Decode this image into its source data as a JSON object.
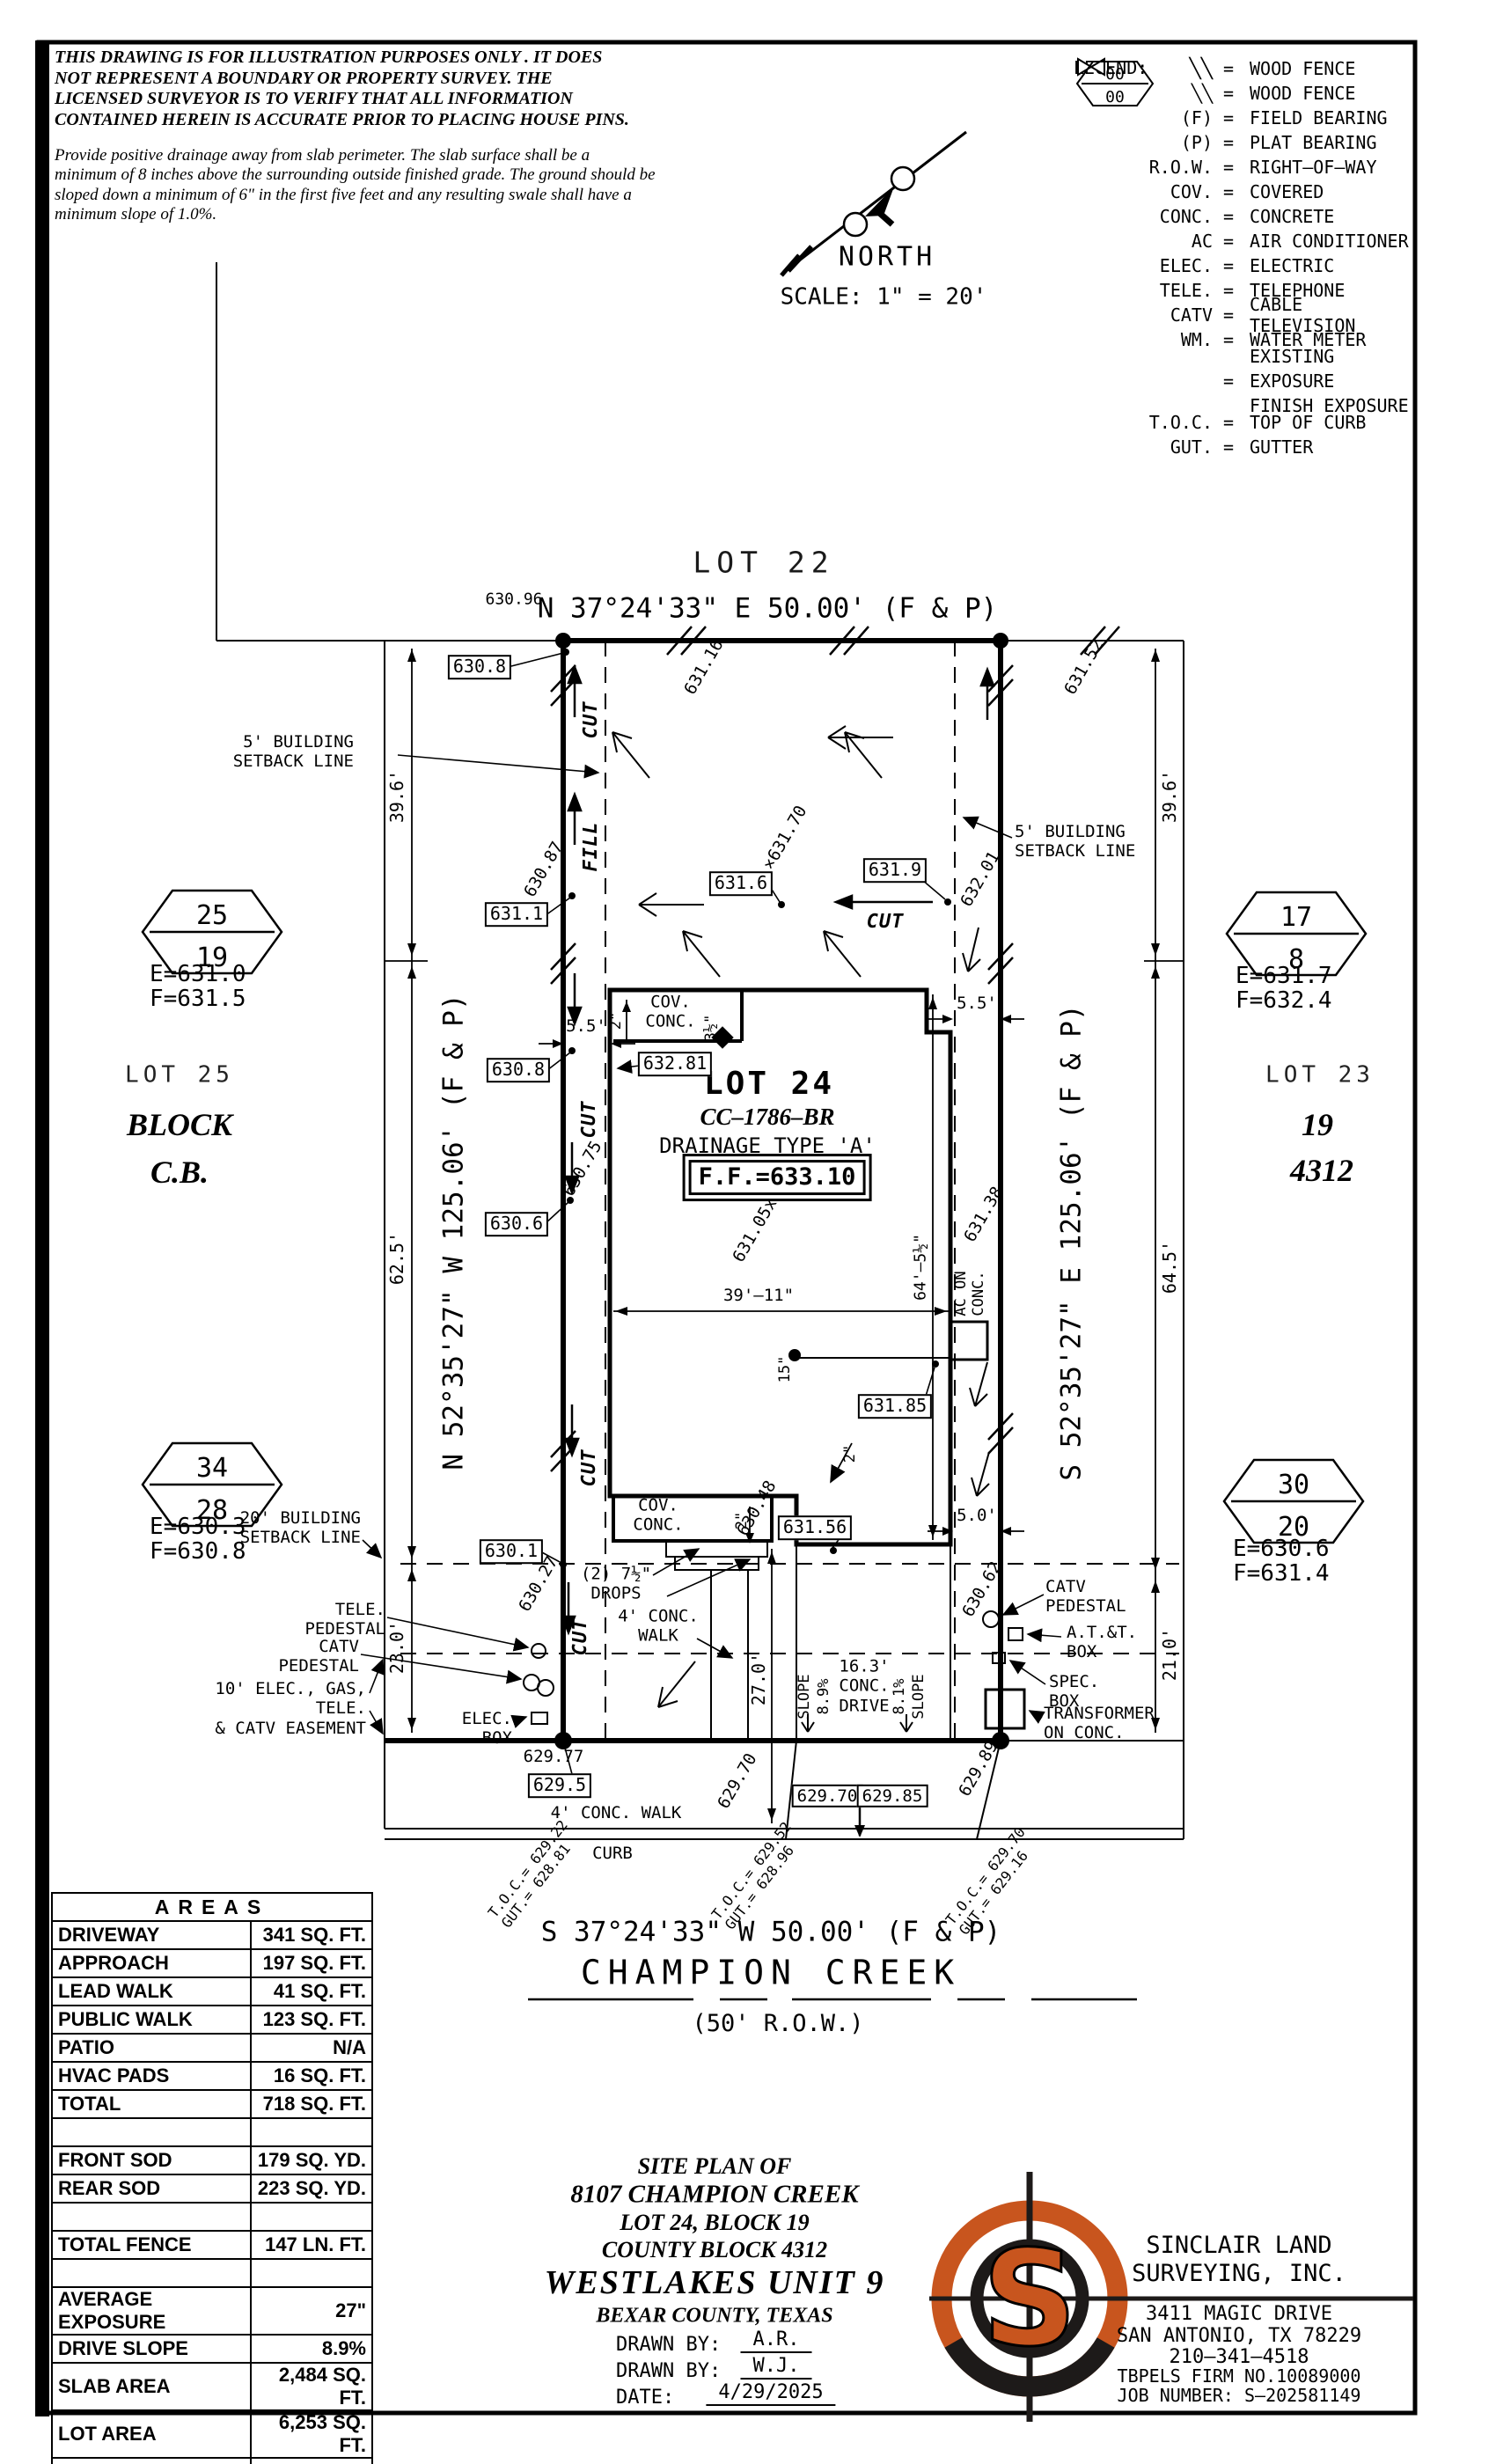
{
  "disclaimer": {
    "p1": "THIS DRAWING IS FOR ILLUSTRATION PURPOSES ONLY . IT DOES\nNOT REPRESENT A BOUNDARY OR PROPERTY SURVEY. THE\nLICENSED SURVEYOR IS TO VERIFY THAT ALL INFORMATION\nCONTAINED HEREIN IS ACCURATE PRIOR TO PLACING HOUSE PINS.",
    "p2": "Provide positive drainage away from slab perimeter. The slab surface shall be a\nminimum of 8 inches above the surrounding outside finished grade. The ground should be\nsloped down a minimum of 6\" in the first five feet and any resulting swale shall have a\nminimum slope of 1.0%."
  },
  "compass": {
    "north": "NORTH",
    "scale": "SCALE: 1\" = 20'"
  },
  "legend": {
    "title": "LEGEND:",
    "eq": "=",
    "items": [
      {
        "sym": "╲╲",
        "def": "WOOD FENCE"
      },
      {
        "sym": "(F)",
        "def": "FIELD BEARING"
      },
      {
        "sym": "(P)",
        "def": "PLAT BEARING"
      },
      {
        "sym": "R.O.W.",
        "def": "RIGHT–OF–WAY"
      },
      {
        "sym": "COV.",
        "def": "COVERED"
      },
      {
        "sym": "CONC.",
        "def": "CONCRETE"
      },
      {
        "sym": "AC",
        "def": "AIR CONDITIONER"
      },
      {
        "sym": "ELEC.",
        "def": "ELECTRIC"
      },
      {
        "sym": "TELE.",
        "def": "TELEPHONE"
      },
      {
        "sym": "CATV",
        "def": "CABLE TELEVISION"
      }
    ],
    "wm": {
      "sym": "WM.",
      "def": "WATER METER"
    },
    "exposure": {
      "top": "00",
      "bottom": "00",
      "def1": "EXISTING EXPOSURE",
      "def2": "FINISH EXPOSURE"
    },
    "items2": [
      {
        "sym": "T.O.C.",
        "def": "TOP OF CURB"
      },
      {
        "sym": "GUT.",
        "def": "GUTTER"
      }
    ]
  },
  "d": {
    "lot22": "LOT 22",
    "brg_top": "N 37°24'33\" E 50.00' (F & P)",
    "brg_bottom": "S 37°24'33\" W 50.00' (F & P)",
    "brg_left": "N 52°35'27\" W 125.06' (F & P)",
    "brg_right": "S 52°35'27\" E 125.06' (F & P)",
    "champion": "CHAMPION CREEK",
    "row50": "(50' R.O.W.)",
    "lot25": "LOT 25",
    "block": "BLOCK",
    "cb": "C.B.",
    "lot23": "LOT 23",
    "n19": "19",
    "n4312": "4312",
    "lot24": "LOT 24",
    "cc": "CC–1786–BR",
    "drainage": "DRAINAGE TYPE 'A'",
    "ff": "F.F.=633.10",
    "cov_conc": "COV.\nCONC.",
    "ac_on_conc": "AC ON\nCONC.",
    "setback5": "5' BUILDING\nSETBACK LINE",
    "setback20": "20' BUILDING\nSETBACK LINE",
    "easement10": "10' ELEC., GAS, TELE.\n& CATV EASEMENT",
    "tele_ped": "TELE.\nPEDESTAL",
    "catv_ped": "CATV\nPEDESTAL",
    "elec_box": "ELEC.\nBOX",
    "att_box": "A.T.&T.\nBOX",
    "spec_box": "SPEC.\nBOX",
    "transformer": "TRANSFORMER\nON CONC.",
    "drops": "(2) 7½\"\nDROPS",
    "walk4": "4' CONC.\nWALK",
    "walk4_street": "4' CONC. WALK",
    "curb": "CURB",
    "drive": "16.3'\nCONC.\nDRIVE",
    "slope": "SLOPE",
    "s89": "8.9%",
    "s81": "8.1%",
    "cut": "CUT",
    "fill": "FILL",
    "d39_6": "39.6'",
    "d62_5": "62.5'",
    "d23_0": "23.0'",
    "d64_5": "64.5'",
    "d21_0": "21.0'",
    "d27_0": "27.0'",
    "d5_5": "5.5'",
    "d5_0": "5.0'",
    "d39_11": "39'–11\"",
    "d64_511": "64'–5½\"",
    "d15": "15\"",
    "d2": "2\"",
    "d3h": "3½\"",
    "s630_96": "630.96",
    "s629_77": "629.77",
    "b630_8a": "630.8",
    "b631_1": "631.1",
    "b630_8b": "630.8",
    "b630_6": "630.6",
    "b630_1": "630.1",
    "b629_5": "629.5",
    "b631_6": "631.6",
    "b631_9": "631.9",
    "b631_85": "631.85",
    "b631_56": "631.56",
    "b632_81": "632.81",
    "b629_70": "629.70",
    "b629_85": "629.85",
    "r631_16": "631.16",
    "r631_52": "631.52",
    "r630_87": "630.87",
    "r631_70": "×631.70",
    "r632_01": "632.01",
    "r630_75": "630.75",
    "r631_38": "631.38",
    "r631_05": "631.05x",
    "r630_48": "630.48",
    "r630_27": "630.27",
    "r630_62": "630.62",
    "r629_89": "629.89",
    "r629_70": "629.70"
  },
  "curb_spots": [
    {
      "txt": "T.O.C.= 629.22\nGUT.= 628.81"
    },
    {
      "txt": "T.O.C.= 629.52\nGUT.= 628.96"
    },
    {
      "txt": "T.O.C.= 629.70\nGUT.= 629.16"
    }
  ],
  "exposure": [
    {
      "top": "25",
      "bottom": "19",
      "e": "E=631.0",
      "f": "F=631.5"
    },
    {
      "top": "34",
      "bottom": "28",
      "e": "E=630.3",
      "f": "F=630.8"
    },
    {
      "top": "17",
      "bottom": "8",
      "e": "E=631.7",
      "f": "F=632.4"
    },
    {
      "top": "30",
      "bottom": "20",
      "e": "E=630.6",
      "f": "F=631.4"
    }
  ],
  "areas": {
    "title": "AREAS",
    "rows": [
      {
        "label": "DRIVEWAY",
        "value": "341 SQ. FT."
      },
      {
        "label": "APPROACH",
        "value": "197 SQ. FT."
      },
      {
        "label": "LEAD WALK",
        "value": "41 SQ. FT."
      },
      {
        "label": "PUBLIC WALK",
        "value": "123 SQ. FT."
      },
      {
        "label": "PATIO",
        "value": "N/A"
      },
      {
        "label": "HVAC PADS",
        "value": "16 SQ. FT."
      },
      {
        "label": "TOTAL",
        "value": "718 SQ. FT."
      },
      {
        "label": "",
        "value": ""
      },
      {
        "label": "FRONT SOD",
        "value": "179 SQ. YD."
      },
      {
        "label": "REAR SOD",
        "value": "223 SQ. YD."
      },
      {
        "label": "",
        "value": ""
      },
      {
        "label": "TOTAL FENCE",
        "value": "147 LN. FT."
      },
      {
        "label": "",
        "value": ""
      },
      {
        "label": "AVERAGE EXPOSURE",
        "value": "27\""
      },
      {
        "label": "DRIVE SLOPE",
        "value": "8.9%"
      },
      {
        "label": "SLAB AREA",
        "value": "2,484 SQ. FT."
      },
      {
        "label": "LOT AREA",
        "value": "6,253 SQ. FT."
      },
      {
        "label": "",
        "value": ""
      }
    ]
  },
  "titleblock": {
    "l1": "SITE PLAN OF",
    "l2": "8107 CHAMPION CREEK",
    "l3": "LOT 24, BLOCK 19",
    "l4": "COUNTY BLOCK 4312",
    "l5": "WESTLAKES UNIT 9",
    "l6": "BEXAR COUNTY, TEXAS",
    "drawn_by_label": "DRAWN BY:",
    "drawn_by_1": "A.R.",
    "drawn_by_2": "W.J.",
    "date_label": "DATE:",
    "date": "4/29/2025"
  },
  "company": {
    "logo_letter": "S",
    "name1": "SINCLAIR LAND",
    "name2": "SURVEYING, INC.",
    "addr1": "3411 MAGIC DRIVE",
    "addr2": "SAN ANTONIO, TX 78229",
    "phone": "210–341–4518",
    "firm": "TBPELS FIRM NO.10089000",
    "job": "JOB NUMBER: S–202581149"
  },
  "colors": {
    "ink": "#000000",
    "accent_orange": "#C8551E"
  }
}
